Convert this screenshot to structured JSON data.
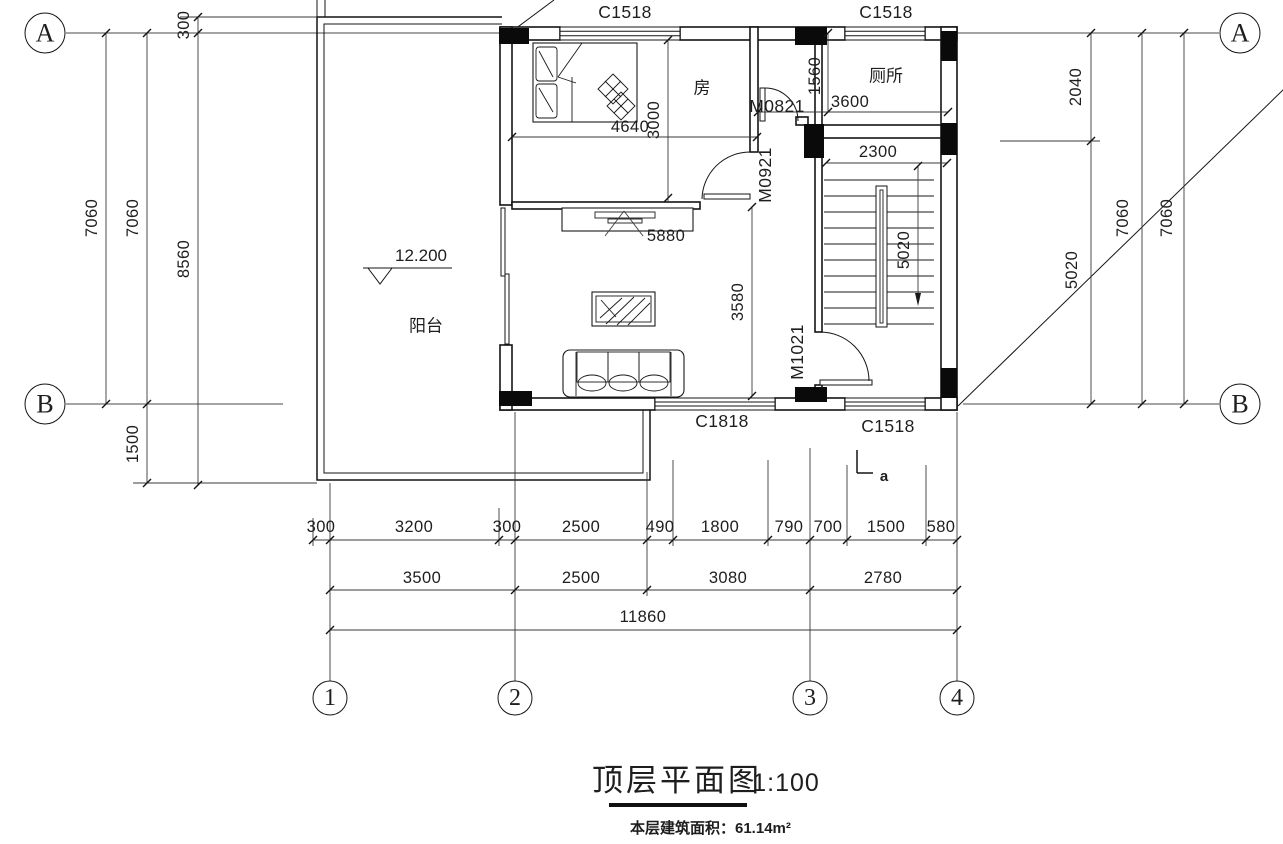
{
  "title_block": {
    "title": "顶层平面图",
    "scale": "1:100",
    "area_note": "本层建筑面积：61.14m²"
  },
  "axes": {
    "horizontal": [
      "A",
      "B"
    ],
    "vertical": [
      "1",
      "2",
      "3",
      "4"
    ]
  },
  "rooms": {
    "bedroom": "房",
    "toilet": "厕所",
    "balcony": "阳台"
  },
  "windows": {
    "c1518": "C1518",
    "c1818": "C1818"
  },
  "doors": {
    "m0821": "M0821",
    "m0921": "M0921",
    "m1021": "M1021"
  },
  "level_mark": "12.200",
  "section_mark": "a",
  "dims": {
    "left": [
      "7060",
      "7060",
      "8560",
      "300",
      "1500"
    ],
    "right": [
      "2040",
      "5020",
      "7060",
      "7060"
    ],
    "interior": {
      "bed_width": "4640",
      "bedroom_depth": "3000",
      "hall_width": "5880",
      "hall_depth": "3580",
      "lobby_depth": "1560",
      "toilet_width": "3600",
      "stair_width": "2300",
      "stair_run": "5020"
    },
    "bottom_row1": [
      "300",
      "3200",
      "300",
      "2500",
      "490",
      "1800",
      "790",
      "700",
      "1500",
      "580"
    ],
    "bottom_row2": [
      "3500",
      "2500",
      "3080",
      "2780"
    ],
    "total": "11860"
  }
}
